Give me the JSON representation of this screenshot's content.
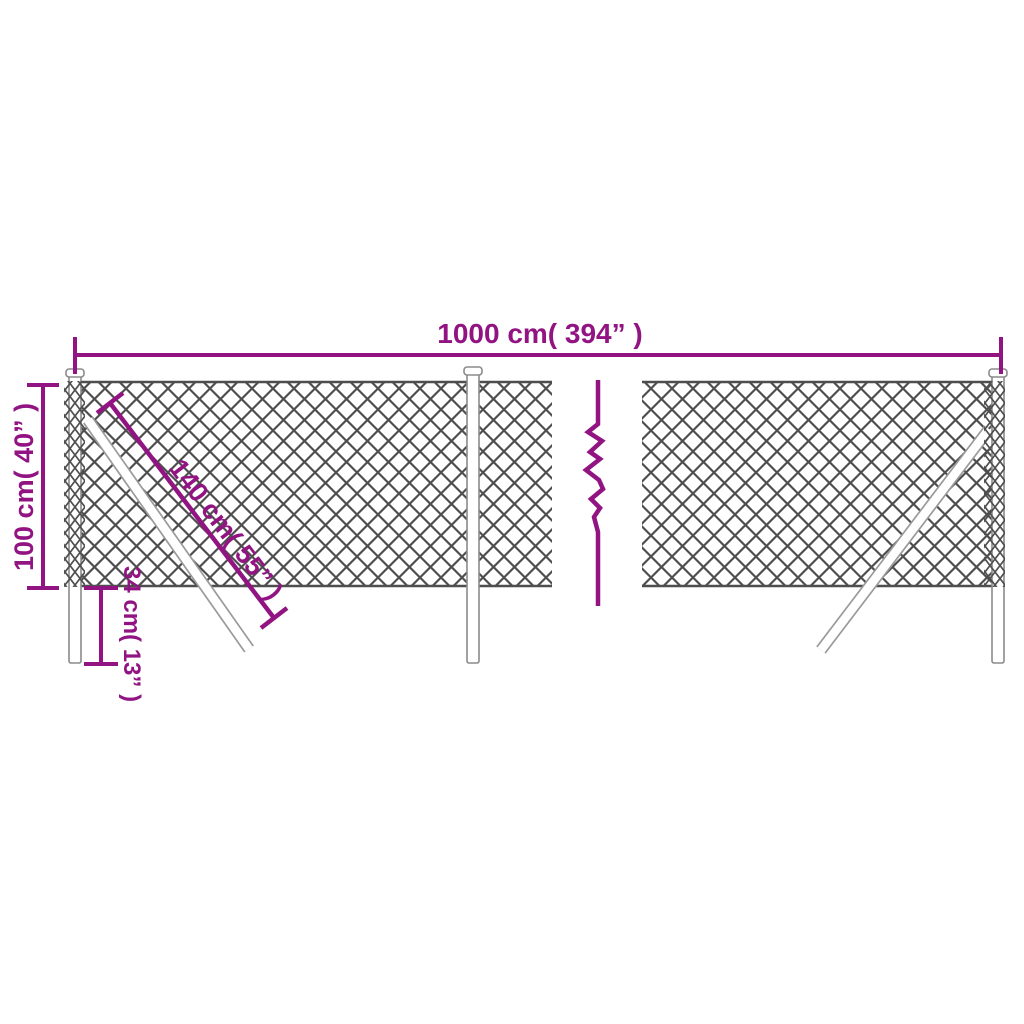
{
  "diagram": {
    "type": "product-dimension-diagram",
    "subject": "chain-link fence with posts and braces",
    "labels": {
      "total_width": "1000 cm( 394” )",
      "height": "100 cm( 40” )",
      "brace_length": "140 cm( 55” )",
      "post_embed_depth": "34 cm( 13” )"
    },
    "colors": {
      "dimension": "#911482",
      "mesh": "#4e4e4e",
      "post_outline": "#8b8b8b",
      "brace_outline": "#9a9a9a",
      "background": "#ffffff"
    }
  }
}
